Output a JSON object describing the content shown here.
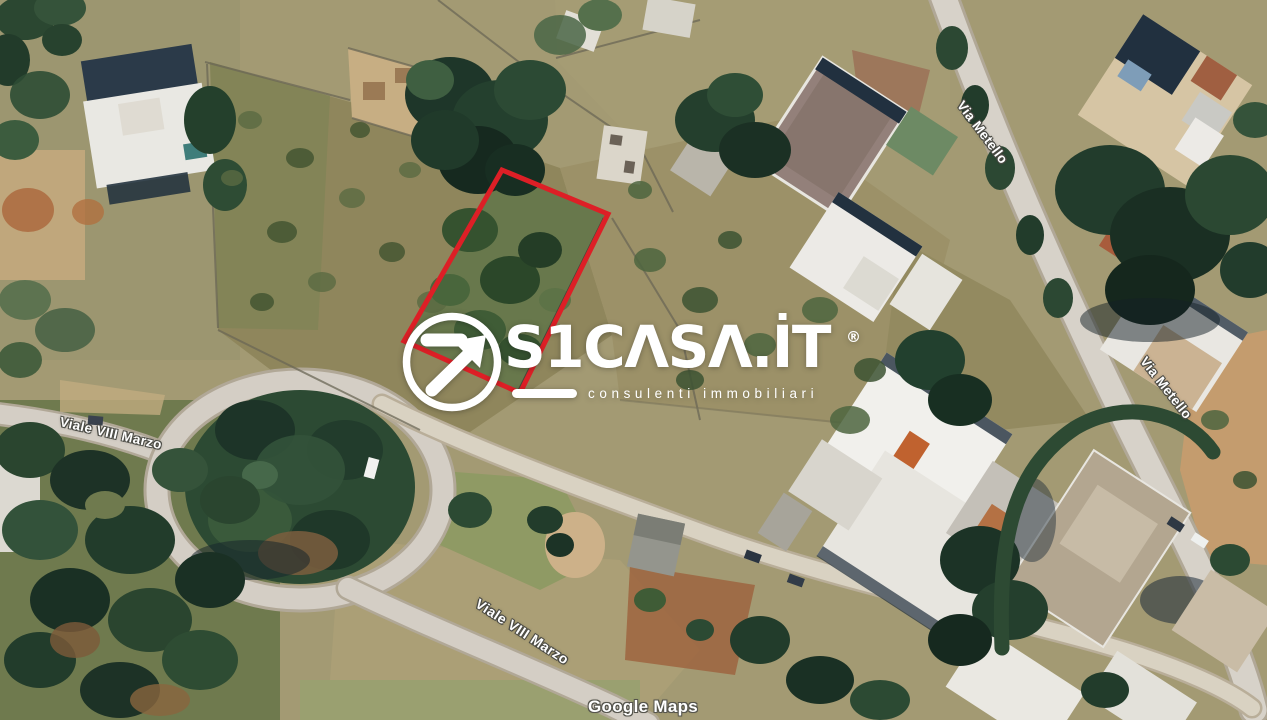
{
  "theme": {
    "parcel_outline": "#dd1f26",
    "map_label": "#ffffff",
    "label_outline": "#4a4a44",
    "watermark": "#ffffff",
    "attribution": "#ffffff"
  },
  "map": {
    "attribution": "Google Maps",
    "parcel": {
      "outline_color": "#dd1f26"
    },
    "roads": [
      {
        "id": "viale-viii-marzo-west",
        "text": "Viale VIII Marzo"
      },
      {
        "id": "via-metello-north",
        "text": "Via Metello"
      },
      {
        "id": "via-metello-east",
        "text": "Via Metello"
      },
      {
        "id": "viale-viii-marzo-south",
        "text": "Viale VIII Marzo"
      }
    ]
  },
  "watermark": {
    "brand": "S1CASA.IT",
    "brand_display": "S1CΛSΛ.İT",
    "registered": "®",
    "tagline": "consulenti immobiliari"
  }
}
